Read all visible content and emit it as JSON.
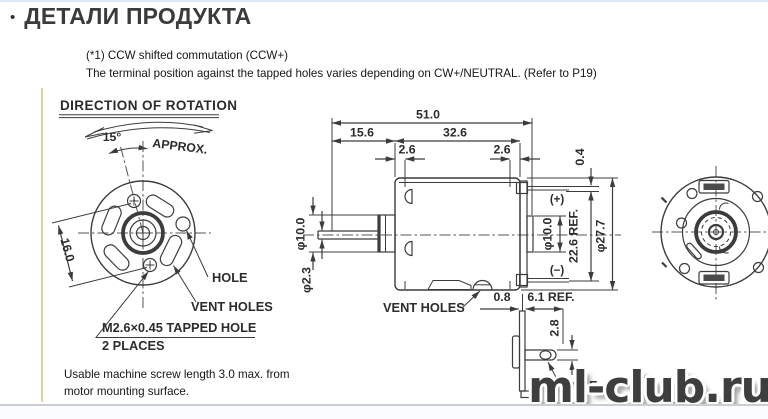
{
  "header": {
    "bullet": "•",
    "title": "ДЕТАЛИ ПРОДУКТА"
  },
  "notes": {
    "line1": "(*1) CCW shifted commutation (CCW+)",
    "line2": "The terminal position against the tapped holes varies depending on CW+/NEUTRAL. (Refer to P19)"
  },
  "front": {
    "heading": "DIRECTION OF ROTATION",
    "angle": "15°",
    "approx": "APPROX.",
    "dim16": "16.0",
    "hole": "HOLE",
    "vent": "VENT HOLES",
    "tapped": "M2.6×0.45 TAPPED HOLE",
    "places": "2 PLACES"
  },
  "side": {
    "d51": "51.0",
    "d156": "15.6",
    "d326": "32.6",
    "d26a": "2.6",
    "d26b": "2.6",
    "d04": "0.4",
    "dia10f": "φ10.0",
    "dia23": "φ2.3",
    "dia10r": "φ10.0",
    "d226": "22.6 REF.",
    "dia277": "φ27.7",
    "plus": "(+)",
    "minus": "(−)",
    "vent": "VENT HOLES"
  },
  "detail": {
    "d08": "0.8",
    "d61": "6.1 REF.",
    "d28": "2.8",
    "hole": "HOLE"
  },
  "footnote": {
    "line1": "Usable machine screw length 3.0 max. from",
    "line2": "motor mounting surface."
  },
  "watermark": {
    "text": "ml-club.ru"
  }
}
